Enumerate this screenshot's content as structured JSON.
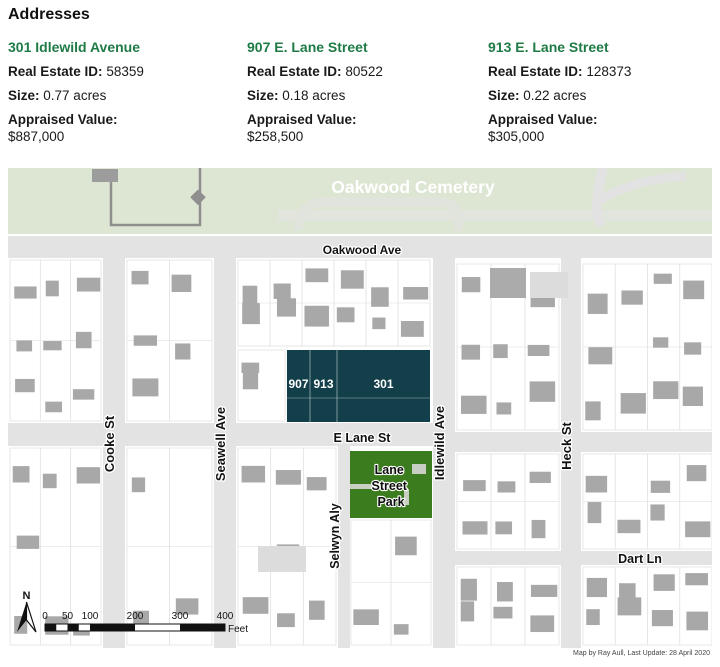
{
  "page": {
    "title": "Addresses"
  },
  "labels": {
    "id": "Real Estate ID:",
    "size": "Size:",
    "value": "Appraised Value:"
  },
  "properties": [
    {
      "address": "301 Idlewild Avenue",
      "id": "58359",
      "size": "0.77 acres",
      "value": "$887,000"
    },
    {
      "address": "907 E. Lane Street",
      "id": "80522",
      "size": "0.18 acres",
      "value": "$258,500"
    },
    {
      "address": "913 E. Lane Street",
      "id": "128373",
      "size": "0.22 acres",
      "value": "$305,000"
    }
  ],
  "map": {
    "cemetery_label": "Oakwood Cemetery",
    "roads": {
      "oakwood_ave": "Oakwood Ave",
      "e_lane_st": "E Lane St",
      "cooke_st": "Cooke St",
      "seawell_ave": "Seawell Ave",
      "selwyn_aly": "Selwyn Aly",
      "idlewild_ave": "Idlewild Ave",
      "heck_st": "Heck St",
      "dart_ln": "Dart Ln"
    },
    "parcels": [
      {
        "label": "907"
      },
      {
        "label": "913"
      },
      {
        "label": "301"
      }
    ],
    "park": {
      "lines": [
        "Lane",
        "Street",
        "Park"
      ]
    },
    "north": "N",
    "scalebar": {
      "ticks": [
        "0",
        "50",
        "100",
        "200",
        "300",
        "400"
      ],
      "unit": "Feet"
    },
    "attribution": "Map by Ray Aull, Last Update: 28 April 2020",
    "colors": {
      "accent_green": "#1e7b45",
      "parcel_teal": "#133f4a",
      "park_green": "#3b7d1e",
      "cemetery_green": "#dde6d3",
      "road_gray": "#e3e3e3",
      "building_gray": "#a8a8a8"
    }
  }
}
